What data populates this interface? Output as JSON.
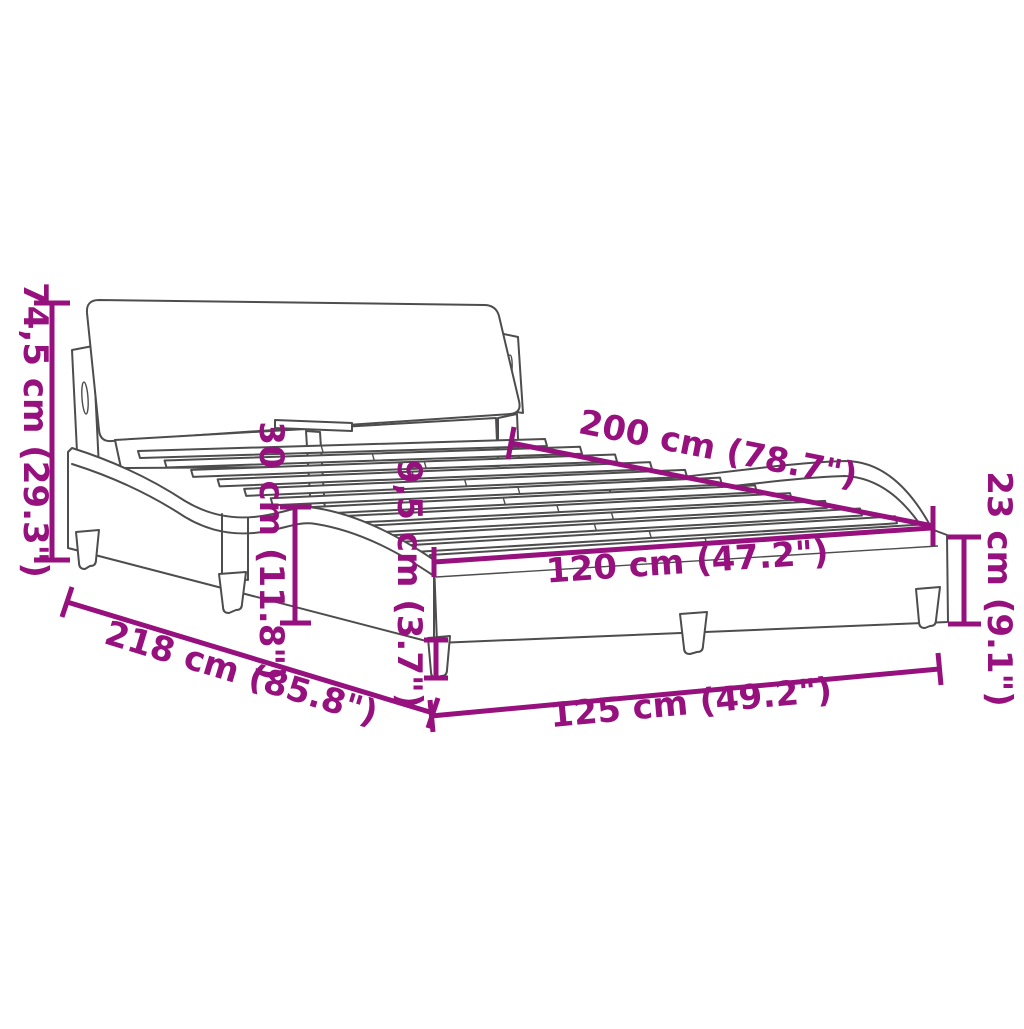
{
  "diagram": {
    "type": "product-dimension-diagram",
    "product": "bed-frame-with-headboard",
    "colors": {
      "background": "#ffffff",
      "drawing_line": "#4d4d4d",
      "dimension_accent": "#96117E"
    },
    "dimensions": [
      {
        "name": "headboard-height",
        "label": "74,5 cm (29.3\")"
      },
      {
        "name": "total-length",
        "label": "218 cm (85.8\")"
      },
      {
        "name": "frame-height",
        "label": "30 cm (11.8\")"
      },
      {
        "name": "leg-height",
        "label": "9,5 cm (3.7\")"
      },
      {
        "name": "slat-area-length",
        "label": "200 cm (78.7\")"
      },
      {
        "name": "inner-width",
        "label": "120 cm (47.2\")"
      },
      {
        "name": "foot-end-height",
        "label": "23 cm (9.1\")"
      },
      {
        "name": "total-width",
        "label": "125 cm (49.2\")"
      }
    ]
  }
}
